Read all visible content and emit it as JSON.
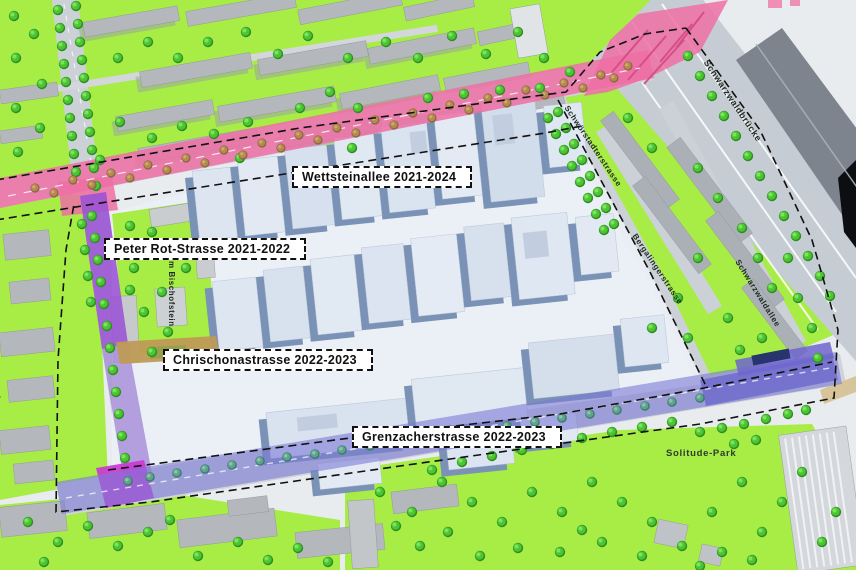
{
  "project_labels": {
    "wettsteinallee": "Wettsteinallee 2021-2024",
    "peter_rot_strasse": "Peter Rot-Strasse 2021-2022",
    "chrischonastrasse": "Chrischonastrasse 2022-2023",
    "grenzacherstrasse": "Grenzacherstrasse 2022-2023"
  },
  "street_labels": {
    "schwarzwaldbruecke": "Schwarzwaldbrücke",
    "schwoerstadterstrasse": "Schwörstadterstrasse",
    "zum_bischofstein": "Zum Bischofstein",
    "bergalingerstrasse": "Bergalingerstrasse",
    "schwarzwaldallee": "Schwarzwaldallee",
    "alemannengasse": "Alemannengasse"
  },
  "area_labels": {
    "solitude_park": "Solitude-Park"
  },
  "colors": {
    "construction_pink": "#ef6fa4",
    "construction_purple": "#9a52d4",
    "construction_magenta": "#cb38d2",
    "construction_violet": "#7c7ad6",
    "construction_tan": "#bf9a56",
    "park_green": "#a8ec46",
    "tree_green": "#4cc433"
  }
}
